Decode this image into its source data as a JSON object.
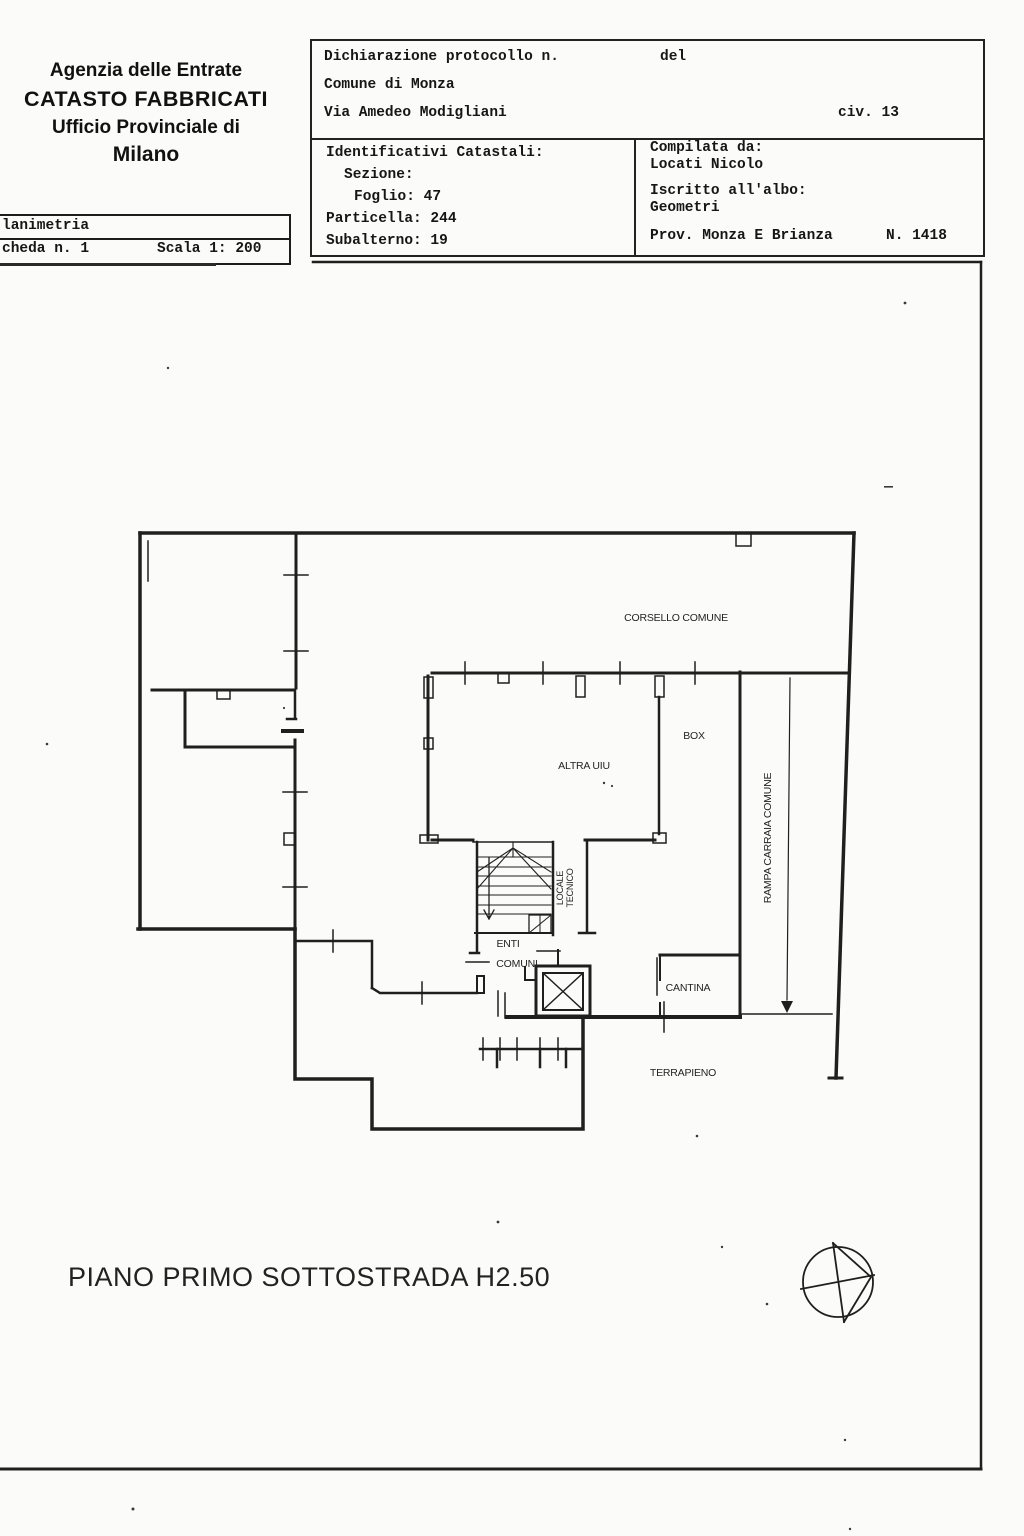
{
  "agency": {
    "line1": "Agenzia delle Entrate",
    "line2": "CATASTO FABBRICATI",
    "line3": "Ufficio Provinciale di",
    "line4": "Milano"
  },
  "scheda_table": {
    "row1": "lanimetria",
    "row2_left": "cheda n. 1",
    "row2_right": "Scala 1: 200"
  },
  "declaration": {
    "protocol_label": "Dichiarazione protocollo n.",
    "del_label": "del",
    "comune": "Comune di Monza",
    "via": "Via Amedeo Modigliani",
    "civico": "civ. 13"
  },
  "cadastral": {
    "title": "Identificativi Catastali:",
    "sezione": "Sezione:",
    "foglio": "Foglio: 47",
    "particella": "Particella: 244",
    "subalterno": "Subalterno: 19"
  },
  "compiler": {
    "compilata_label": "Compilata da:",
    "name": "Locati Nicolo",
    "albo_label": "Iscritto all'albo:",
    "albo": "Geometri",
    "prov": "Prov. Monza E Brianza",
    "num": "N. 1418"
  },
  "plan_labels": {
    "corsello": "CORSELLO COMUNE",
    "box": "BOX",
    "altra_uiu": "ALTRA UIU",
    "rampa": "RAMPA CARRAIA COMUNE",
    "locale_tecnico_1": "LOCALE",
    "locale_tecnico_2": "TECNICO",
    "enti": "ENTI",
    "comuni": "COMUNI",
    "cantina": "CANTINA",
    "terrapieno": "TERRAPIENO"
  },
  "footer": {
    "floor_title": "PIANO PRIMO SOTTOSTRADA H2.50"
  },
  "icons": {
    "compass": "north-arrow-compass"
  },
  "colors": {
    "ink": "#1c1c1c",
    "paper": "#fbfbfa"
  }
}
